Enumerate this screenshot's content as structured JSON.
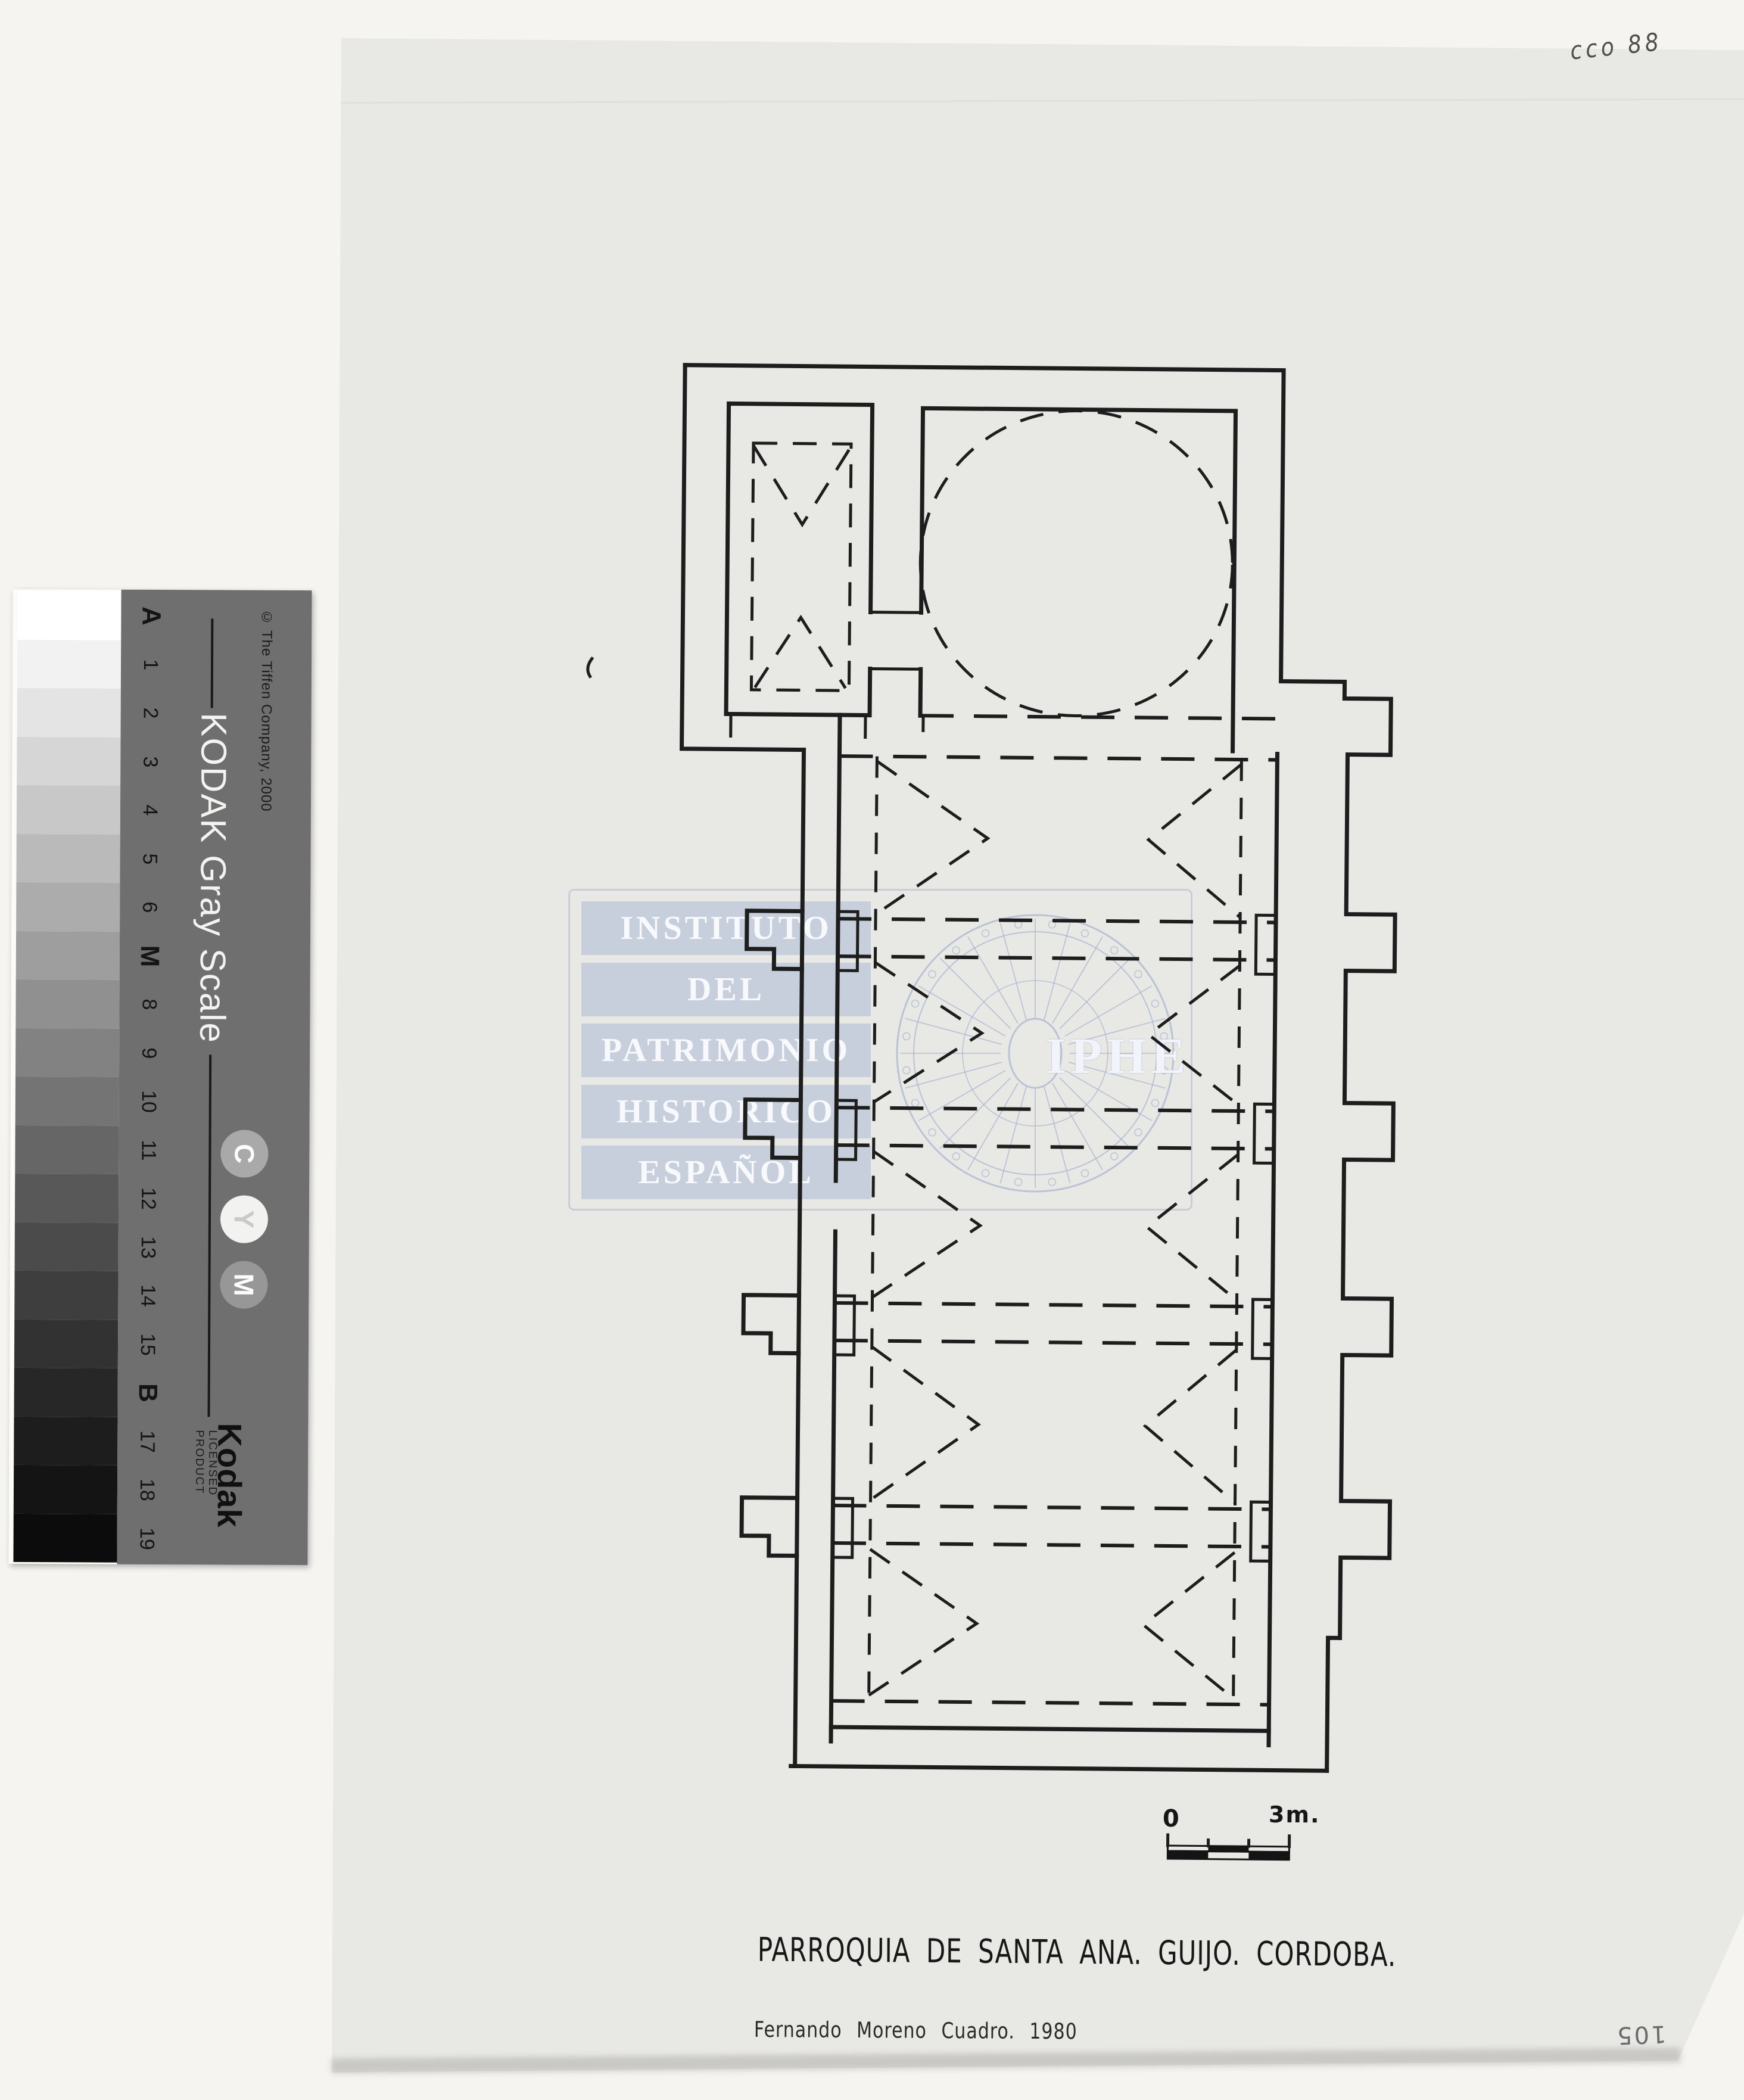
{
  "annotations": {
    "archive_code": "cco 88",
    "page_number": "105"
  },
  "gray_scale": {
    "brand_title": "KODAK Gray Scale",
    "copyright": "© The Tiffen Company, 2000",
    "labels": [
      "A",
      "1",
      "2",
      "3",
      "4",
      "5",
      "6",
      "M",
      "8",
      "9",
      "10",
      "11",
      "12",
      "13",
      "14",
      "15",
      "B",
      "17",
      "18",
      "19"
    ],
    "patch_colors": [
      "#ffffff",
      "#f2f2f2",
      "#e4e4e4",
      "#d6d6d6",
      "#c8c8c8",
      "#bababa",
      "#acacac",
      "#9e9e9e",
      "#909090",
      "#828282",
      "#747474",
      "#666666",
      "#585858",
      "#4b4b4b",
      "#3e3e3e",
      "#323232",
      "#272727",
      "#1d1d1d",
      "#141414",
      "#0c0c0c"
    ],
    "cmy_dots": [
      "C",
      "Y",
      "M"
    ],
    "logo": "Kodak",
    "licensed_text": "LICENSED PRODUCT"
  },
  "watermark": {
    "lines": [
      "INSTITUTO",
      "DEL",
      "PATRIMONIO",
      "HISTORICO",
      "ESPAÑOL"
    ],
    "acronym": "IPHE",
    "band_color": "#b2bed5"
  },
  "drawing": {
    "title": "PARROQUIA DE SANTA ANA. GUIJO. CORDOBA.",
    "author_line": "Fernando Moreno Cuadro. 1980",
    "scale_bar": {
      "left_label": "0",
      "right_label": "3m."
    }
  },
  "colors": {
    "paper": "#e8e8e5",
    "background": "#f5f4f1",
    "ink": "#1d1d1d",
    "card": "#6f6f6f"
  }
}
